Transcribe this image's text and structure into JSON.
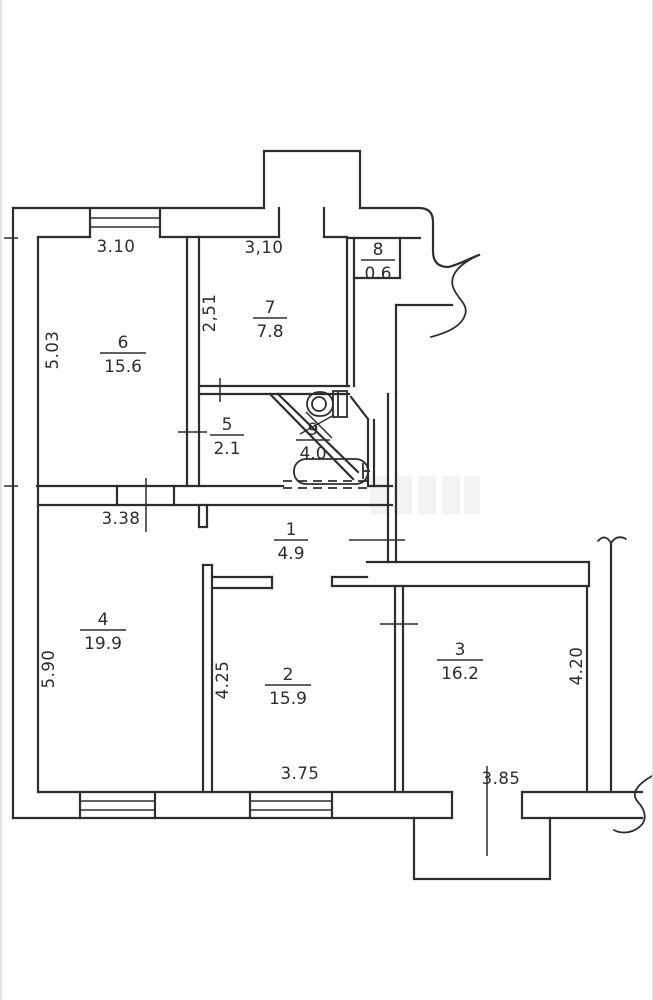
{
  "plan": {
    "title": "apartment-floor-plan",
    "rooms": [
      {
        "number": "1",
        "area": "4.9"
      },
      {
        "number": "2",
        "area": "15.9"
      },
      {
        "number": "3",
        "area": "16.2"
      },
      {
        "number": "4",
        "area": "19.9"
      },
      {
        "number": "5",
        "area": "2.1"
      },
      {
        "number": "6",
        "area": "15.6"
      },
      {
        "number": "7",
        "area": "7.8"
      },
      {
        "number": "8",
        "area": "0.6"
      },
      {
        "number": "9",
        "area": "4.0"
      }
    ],
    "dimensions": {
      "top_left": "3.10",
      "top_right": "3,10",
      "room7_depth": "2,51",
      "room6_depth": "5.03",
      "hall_width": "3.38",
      "room4_depth": "5.90",
      "room2_depth": "4.25",
      "room2_width": "3.75",
      "room3_width": "3.85",
      "room3_depth": "4.20"
    }
  }
}
